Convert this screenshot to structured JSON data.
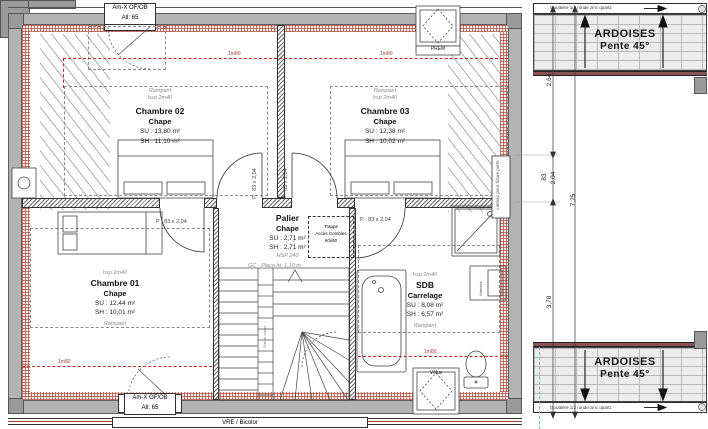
{
  "plan": {
    "windows": {
      "top_label1": "Am-X OF/OB",
      "top_label2": "All: 65",
      "bottom_label1": "Am-X OF/OB",
      "bottom_label2": "All: 65",
      "vre": "VRE / Bicolor"
    },
    "rooms": {
      "chambre02": {
        "rampant": "Rampant",
        "hsp": "hsp 2m40",
        "name": "Chambre 02",
        "finish": "Chape",
        "su": "SU : 13,80 m²",
        "sh": "SH : 11,10 m²"
      },
      "chambre03": {
        "rampant": "Rampant",
        "hsp": "hsp 2m40",
        "name": "Chambre 03",
        "finish": "Chape",
        "su": "SU : 12,38 m²",
        "sh": "SH : 10,02 m²"
      },
      "chambre01": {
        "hsp": "hsp 2m40",
        "name": "Chambre 01",
        "finish": "Chape",
        "su": "SU : 12,44 m²",
        "sh": "SH : 10,01 m²",
        "rampant": "Rampant"
      },
      "palier": {
        "name": "Palier",
        "finish": "Chape",
        "su": "SU : 2,71 m²",
        "sh": "SH : 2,71 m²",
        "hsp": "HSP 240"
      },
      "sdb": {
        "hsp": "hsp 2m40",
        "name": "SDB",
        "finish": "Carrelage",
        "su": "SU : 8,08 m²",
        "sh": "SH : 6,57 m²",
        "rampant": "Rampant"
      }
    },
    "annotations": {
      "trappe1": "Trappe",
      "trappe2": "Accès Combles",
      "trappe3": "60x60",
      "gc": "GC - Placo ht. 1,10 m",
      "garde_corps": "Garde-corps",
      "linteau": "Linteau pour future porte",
      "door_label": "P : 83 x 2,04",
      "hsp_180": "1m80",
      "chimney": "PREM",
      "velux": "Vélux",
      "attentes": "Attentes"
    }
  },
  "section": {
    "ardoises_line1": "ARDOISES",
    "ardoises_line2": "Pente 45°",
    "gouttiere": "Gouttière 1/2 ronde zinc quartz",
    "dims": {
      "a": "2,64",
      "b": "83",
      "c": "2,04",
      "total": "7,25",
      "d": "3,78"
    }
  },
  "colors": {
    "hsp_line": "#c22b22",
    "wall": "#b3b3b3",
    "ridge": "#8a5252"
  }
}
